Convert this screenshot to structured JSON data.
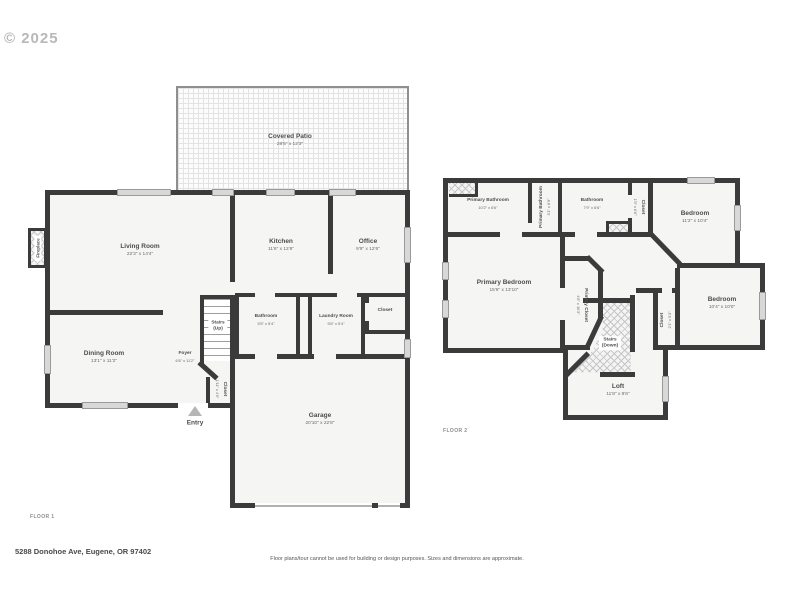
{
  "meta": {
    "copyright": "© 2025",
    "floor1_label": "FLOOR 1",
    "floor2_label": "FLOOR 2",
    "entry_label": "Entry",
    "address": "5288 Donohoe Ave, Eugene, OR 97402",
    "disclaimer": "Floor plans/tour cannot be used for building or design purposes. Sizes and dimensions are approximate."
  },
  "colors": {
    "wall": "#3b3b3b",
    "room_fill": "#f5f5f4",
    "window": "#d8d8d8",
    "text_primary": "#4d4d4d",
    "text_dim": "#6a6a6a",
    "watermark": "#b8b8b8"
  },
  "floor1": {
    "rooms": {
      "covered_patio": {
        "name": "Covered Patio",
        "dims": "28'5\" x 12'3\""
      },
      "living_room": {
        "name": "Living Room",
        "dims": "22'3\" x 14'4\""
      },
      "kitchen": {
        "name": "Kitchen",
        "dims": "11'6\" x 12'6\""
      },
      "office": {
        "name": "Office",
        "dims": "9'9\" x 12'6\""
      },
      "stairs": {
        "name": "Stairs",
        "sub": "(Up)"
      },
      "bathroom": {
        "name": "Bathroom",
        "dims": "5'5\" x 5'4\""
      },
      "laundry": {
        "name": "Laundry Room",
        "dims": "5'6\" x 5'4\""
      },
      "closet_hall": {
        "name": "Closet"
      },
      "dining": {
        "name": "Dining Room",
        "dims": "13'1\" x 11'2\""
      },
      "foyer": {
        "name": "Foyer",
        "dims": "6'6\" x 11'2\""
      },
      "closet_foyer": {
        "name": "Closet",
        "dims": "1'11\" x 4'0\""
      },
      "garage": {
        "name": "Garage",
        "dims": "20'10\" x 22'8\""
      },
      "fireplace": {
        "name": "Fireplace"
      }
    }
  },
  "floor2": {
    "rooms": {
      "primary_bathroom": {
        "name": "Primary Bathroom",
        "dims": "10'2\" x 6'6\""
      },
      "primary_bathroom_2": {
        "name": "Primary Bathroom",
        "dims": "3'1\" x 6'9\""
      },
      "bathroom": {
        "name": "Bathroom",
        "dims": "7'9\" x 6'6\""
      },
      "closet_hall": {
        "name": "Closet",
        "dims": "1'9\" x 6'6\""
      },
      "bedroom_1": {
        "name": "Bedroom",
        "dims": "11'2\" x 10'4\""
      },
      "primary_bedroom": {
        "name": "Primary Bedroom",
        "dims": "15'6\" x 13'10\""
      },
      "primary_closet": {
        "name": "Primary Closet",
        "dims": "4'8\" x 10'3\""
      },
      "stairs": {
        "name": "Stairs",
        "sub": "(Down)"
      },
      "closet_small": {
        "name": "Closet",
        "dims": "2'1\" x 5'3\""
      },
      "bedroom_2": {
        "name": "Bedroom",
        "dims": "10'4\" x 10'0\""
      },
      "loft": {
        "name": "Loft",
        "dims": "11'8\" x 8'6\""
      }
    }
  }
}
